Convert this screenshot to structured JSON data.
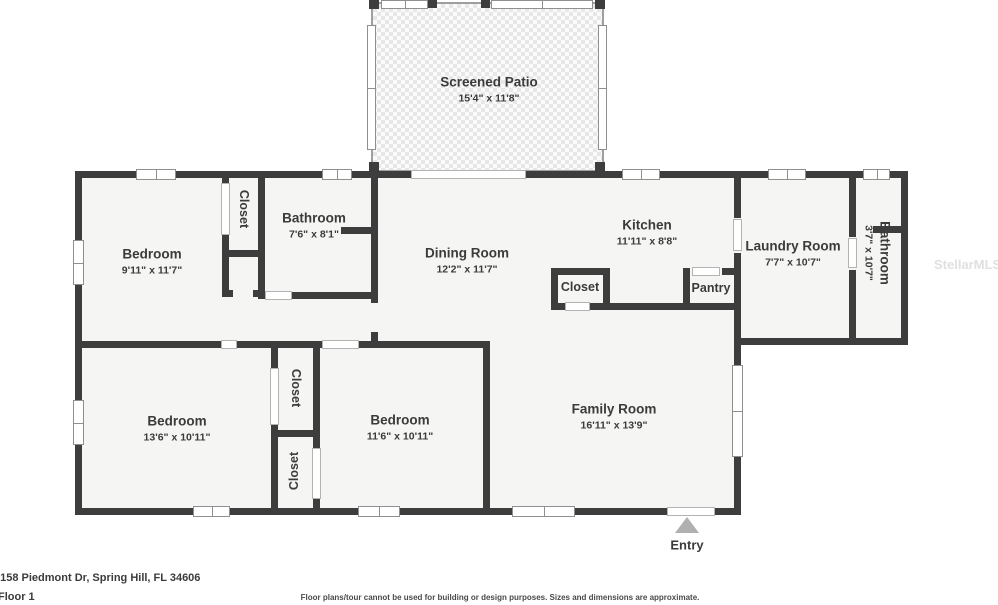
{
  "page": {
    "address": "6158 Piedmont Dr, Spring Hill, FL 34606",
    "floor_label": "Floor 1",
    "disclaimer": "Floor plans/tour cannot be used for building or design purposes. Sizes and dimensions are approximate.",
    "watermark": "StellarMLS",
    "entry": {
      "label": "Entry"
    },
    "rooms": {
      "screened_patio": {
        "name": "Screened Patio",
        "dims": "15'4\" x 11'8\""
      },
      "bedroom_top_left": {
        "name": "Bedroom",
        "dims": "9'11\" x 11'7\""
      },
      "closet_top_left": {
        "name": "Closet"
      },
      "bathroom_top": {
        "name": "Bathroom",
        "dims": "7'6\" x 8'1\""
      },
      "dining_room": {
        "name": "Dining Room",
        "dims": "12'2\" x 11'7\""
      },
      "kitchen": {
        "name": "Kitchen",
        "dims": "11'11\" x 8'8\""
      },
      "closet_mid": {
        "name": "Closet"
      },
      "pantry": {
        "name": "Pantry"
      },
      "laundry_room": {
        "name": "Laundry Room",
        "dims": "7'7\" x 10'7\""
      },
      "bathroom_right": {
        "name": "Bathroom",
        "dims": "3'7\" x 10'7\""
      },
      "bedroom_bottom_left": {
        "name": "Bedroom",
        "dims": "13'6\" x 10'11\""
      },
      "closet_upper": {
        "name": "Closet"
      },
      "closet_lower": {
        "name": "Closet"
      },
      "bedroom_bottom_mid": {
        "name": "Bedroom",
        "dims": "11'6\" x 10'11\""
      },
      "family_room": {
        "name": "Family Room",
        "dims": "16'11\" x 13'9\""
      }
    },
    "colors": {
      "wall": "#3d3d3d",
      "room_fill": "#f5f5f4",
      "text": "#3b3b3b",
      "entry_arrow": "#b0b0b0"
    }
  }
}
